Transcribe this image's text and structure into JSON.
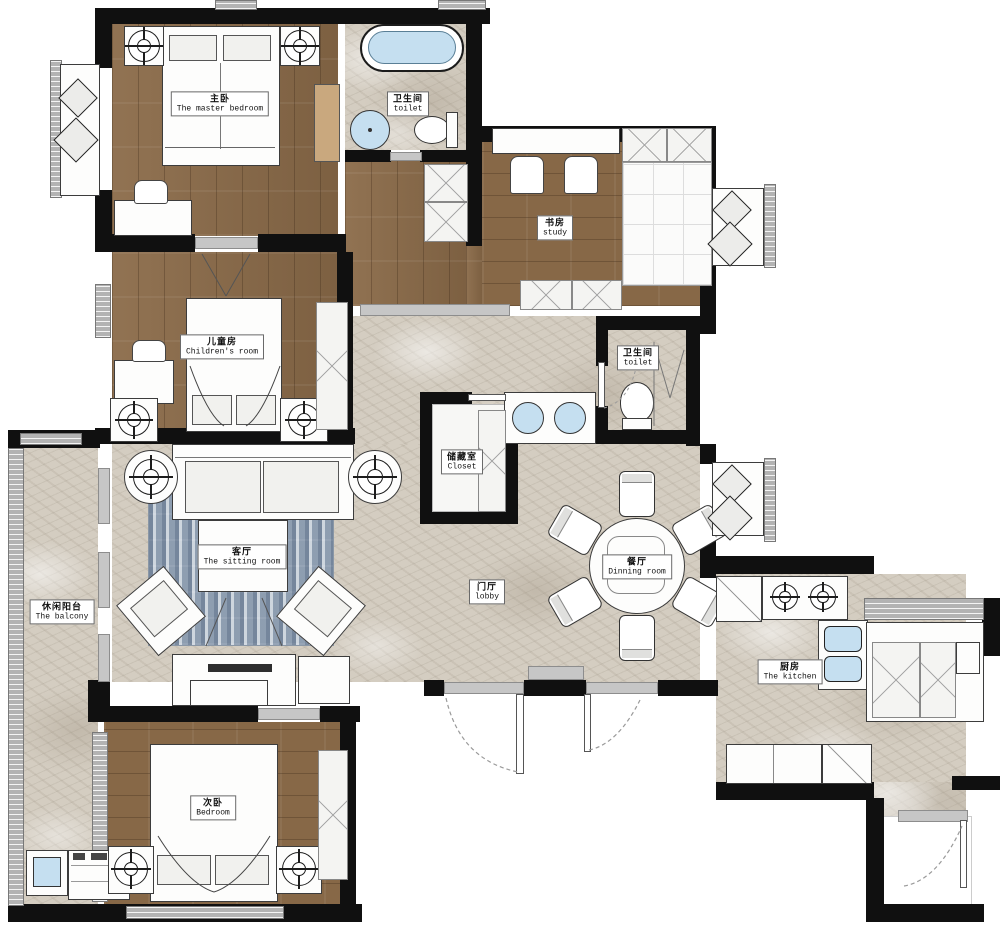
{
  "title": "apartment-floor-plan",
  "rooms": {
    "master_bedroom": {
      "zh": "主卧",
      "en": "The master bedroom"
    },
    "master_toilet": {
      "zh": "卫生间",
      "en": "toilet"
    },
    "study": {
      "zh": "书房",
      "en": "study"
    },
    "children_room": {
      "zh": "儿童房",
      "en": "Children's room"
    },
    "guest_toilet": {
      "zh": "卫生间",
      "en": "toilet"
    },
    "closet": {
      "zh": "储藏室",
      "en": "Closet"
    },
    "sitting_room": {
      "zh": "客厅",
      "en": "The sitting room"
    },
    "lobby": {
      "zh": "门厅",
      "en": "lobby"
    },
    "balcony": {
      "zh": "休闲阳台",
      "en": "The balcony"
    },
    "dining_room": {
      "zh": "餐厅",
      "en": "Dinning room"
    },
    "kitchen": {
      "zh": "厨房",
      "en": "The kitchen"
    },
    "second_bedroom": {
      "zh": "次卧",
      "en": "Bedroom"
    }
  },
  "palette": {
    "wall": "#101010",
    "wood_floor": "#8b6b49",
    "marble_floor": "#d4cdc1",
    "water_blue": "#c5dff0",
    "rug_blue": "#a7b4c2",
    "window_gray": "#b3b3b3"
  },
  "icons": {
    "ceiling-lamp-icon": "crosshair-circle",
    "door-swing-icon": "dashed-arc",
    "downlight-icon": "v-lines",
    "burner-icon": "crosshair-circle"
  }
}
